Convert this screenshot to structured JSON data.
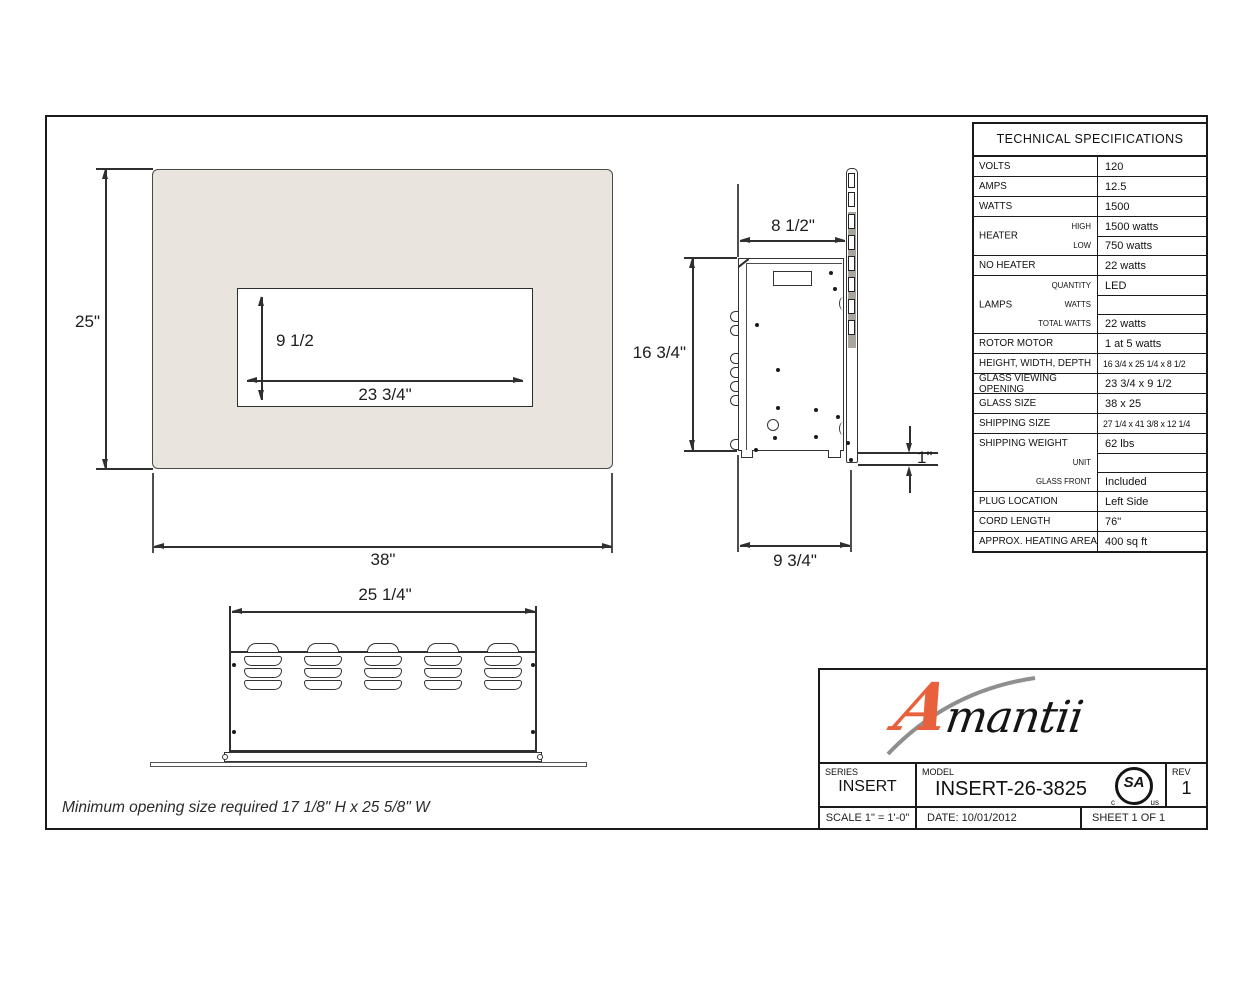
{
  "note": "Minimum opening size required 17 1/8\" H x 25 5/8\" W",
  "dims": {
    "front_height": "25\"",
    "front_width": "38\"",
    "opening_height": "9 1/2",
    "opening_width": "23 3/4\"",
    "side_top_depth": "8 1/2\"",
    "side_height": "16 3/4\"",
    "side_bottom_depth": "9 3/4\"",
    "flange_depth": "1\"",
    "rear_width": "25 1/4\""
  },
  "spec_table": {
    "title": "TECHNICAL SPECIFICATIONS",
    "rows": [
      {
        "label": "VOLTS",
        "value": "120"
      },
      {
        "label": "AMPS",
        "value": "12.5"
      },
      {
        "label": "WATTS",
        "value": "1500"
      },
      {
        "label": "HEATER",
        "subs": [
          {
            "sub": "HIGH",
            "value": "1500 watts"
          },
          {
            "sub": "LOW",
            "value": "750 watts"
          }
        ]
      },
      {
        "label": "NO HEATER",
        "value": "22 watts"
      },
      {
        "label": "LAMPS",
        "subs": [
          {
            "sub": "QUANTITY",
            "value": "LED"
          },
          {
            "sub": "WATTS",
            "value": ""
          },
          {
            "sub": "TOTAL WATTS",
            "value": "22 watts"
          }
        ]
      },
      {
        "label": "ROTOR MOTOR",
        "value": "1 at 5 watts"
      },
      {
        "label": "HEIGHT, WIDTH, DEPTH",
        "value": "16 3/4 x 25 1/4 x 8 1/2"
      },
      {
        "label": "GLASS VIEWING OPENING",
        "value": "23 3/4 x 9 1/2"
      },
      {
        "label": "GLASS SIZE",
        "value": "38 x 25"
      },
      {
        "label": "SHIPPING SIZE",
        "value": "27 1/4 x 41 3/8 x 12 1/4"
      },
      {
        "label": "SHIPPING WEIGHT",
        "subs": [
          {
            "sub": "",
            "value": "62 lbs"
          },
          {
            "sub": "UNIT",
            "value": ""
          },
          {
            "sub": "GLASS FRONT",
            "value": "Included"
          }
        ]
      },
      {
        "label": "PLUG LOCATION",
        "value": "Left Side"
      },
      {
        "label": "CORD LENGTH",
        "value": "76\""
      },
      {
        "label": "APPROX. HEATING AREA",
        "value": "400 sq ft"
      }
    ]
  },
  "title_block": {
    "logo_first": "A",
    "logo_rest": "mantii",
    "series_label": "SERIES",
    "series_value": "INSERT",
    "model_label": "MODEL",
    "model_value": "INSERT-26-3825",
    "rev_label": "REV",
    "rev_value": "1",
    "scale_text": "SCALE 1\" = 1'-0\"",
    "date_text": "DATE: 10/01/2012",
    "sheet_text": "SHEET 1 OF 1",
    "csa_sa": "SA",
    "csa_c": "c",
    "csa_us": "us"
  },
  "colors": {
    "accent_orange": "#e8603c",
    "surround_beige": "#e9e4dd",
    "line": "#2f2f2f"
  }
}
